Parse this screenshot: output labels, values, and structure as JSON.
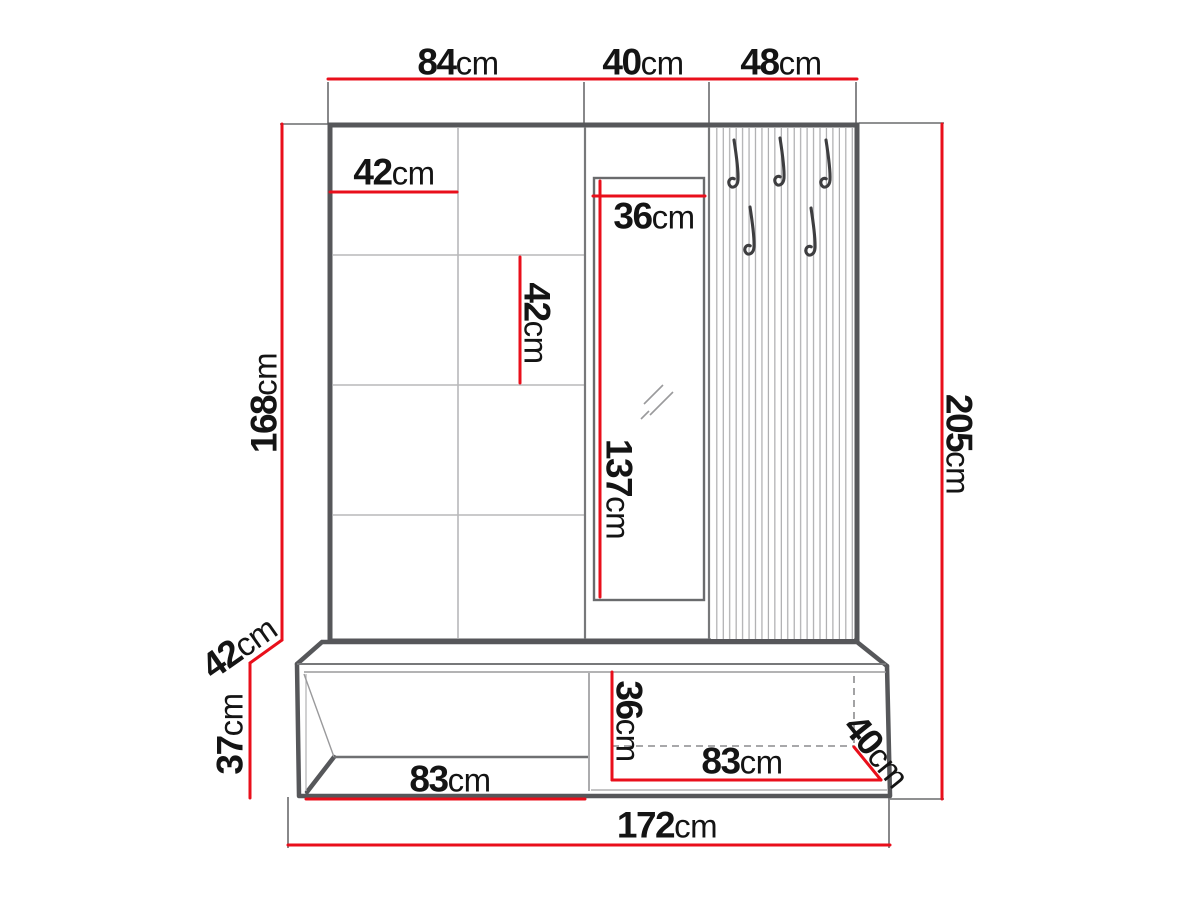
{
  "diagram": {
    "title": "hallway-furniture-dimension-drawing",
    "unit": "cm",
    "colors": {
      "dimension_red": "#e90f1b",
      "outline_gray": "#56575a",
      "text_black": "#141414"
    },
    "dims": {
      "top_left_84": {
        "value": "84",
        "unit": "cm"
      },
      "top_mirror_40": {
        "value": "40",
        "unit": "cm"
      },
      "top_hooks_48": {
        "value": "48",
        "unit": "cm"
      },
      "cushion_w_42": {
        "value": "42",
        "unit": "cm"
      },
      "cushion_h_42": {
        "value": "42",
        "unit": "cm"
      },
      "mirror_w_36": {
        "value": "36",
        "unit": "cm"
      },
      "mirror_h_137": {
        "value": "137",
        "unit": "cm"
      },
      "panel_h_168": {
        "value": "168",
        "unit": "cm"
      },
      "depth_42": {
        "value": "42",
        "unit": "cm"
      },
      "bench_h_37": {
        "value": "37",
        "unit": "cm"
      },
      "shelf_w_83": {
        "value": "83",
        "unit": "cm"
      },
      "drawer_h_36": {
        "value": "36",
        "unit": "cm"
      },
      "drawer_w_83": {
        "value": "83",
        "unit": "cm"
      },
      "bench_depth_40": {
        "value": "40",
        "unit": "cm"
      },
      "total_w_172": {
        "value": "172",
        "unit": "cm"
      },
      "total_h_205": {
        "value": "205",
        "unit": "cm"
      }
    }
  }
}
